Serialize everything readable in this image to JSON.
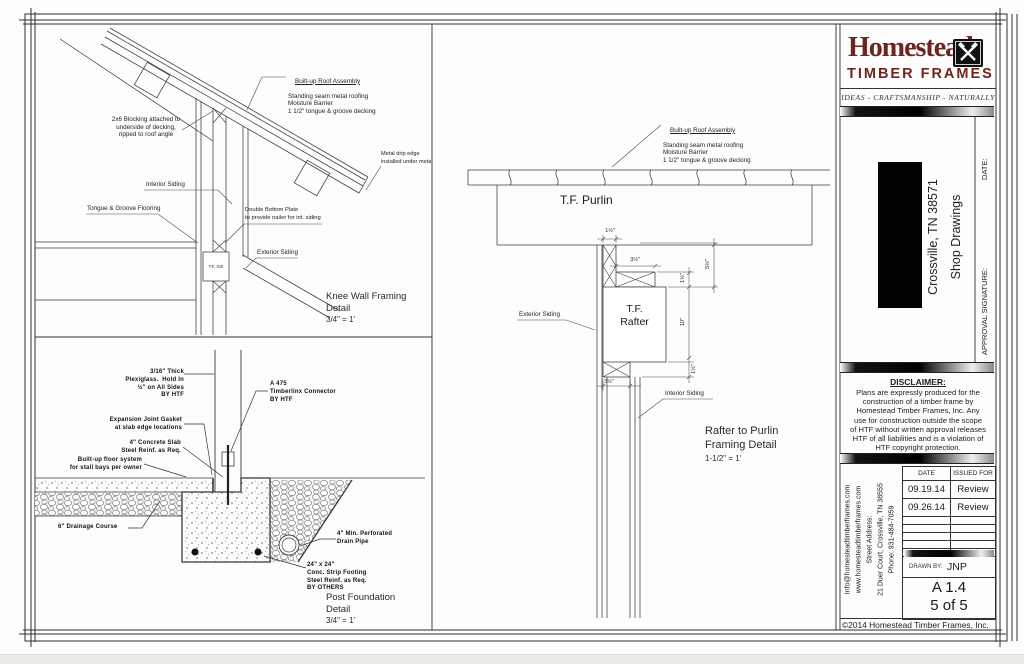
{
  "brand": {
    "name": "Homestead",
    "word2": "TIMBER FRAMES",
    "tagline": "IDEAS - CRAFTSMANSHIP - NATURALLY",
    "color": "#6e2420"
  },
  "project": {
    "location": "Crossville, TN 38571",
    "type": "Shop Drawings",
    "approval_label": "APPROVAL SIGNATURE:",
    "date_label": "DATE:"
  },
  "disclaimer": {
    "title": "DISCLAIMER:",
    "body": "Plans are expressly produced for the\nconstruction of a timber frame by\nHomestead Timber Frames, Inc. Any\nuse for construction outside the scope\nof HTF without written approval releases\nHTF of all liabilities and is a violation of\nHTF copyright protection."
  },
  "contact": {
    "email": "Info@homesteadtimberframes.com",
    "web": "www.homesteadtimberframes.com",
    "street_label": "Street Address:",
    "street": "21 Duer Court, Crossville, TN 38555",
    "phone": "Phone: 931-484-7059"
  },
  "revisions": {
    "date_header": "DATE",
    "issued_header": "ISSUED FOR",
    "rows": [
      [
        "09.19.14",
        "Review"
      ],
      [
        "09.26.14",
        "Review"
      ]
    ]
  },
  "titleblock": {
    "drawn_by_label": "DRAWN BY:",
    "drawn_by": "JNP",
    "sheet": "A 1.4",
    "page": "5 of 5",
    "copyright": "©2014 Homestead Timber Frames, Inc."
  },
  "shared": {
    "roof_assembly_title": "Built-up Roof Assembly",
    "roof_assembly_rest": "Standing seam metal roofing\nMoisture Barrier\n1 1/2\" tongue & groove decking"
  },
  "knee_wall": {
    "blocking": "2x6 Blocking attached to\nunderside of decking,\nripped to roof angle",
    "drip_edge": "Metal drip edge\ninstalled under metal ro",
    "interior_siding": "Interior Siding",
    "tongue_groove": "Tongue & Groove Flooring",
    "double_bottom_plate": "Double Bottom Plate\nto provide nailer for int. siding",
    "exterior_siding": "Exterior Siding",
    "girt": "T.F. Girt",
    "title": "Knee Wall Framing\nDetail",
    "scale": "3/4\" = 1'"
  },
  "post_foundation": {
    "plexiglass": "3/16\" Thick\nPlexiglass.  Hold In\n½\" on All Sides\nBY HTF",
    "connector": "A 475\nTimberlinx Connector\nBY HTF",
    "expansion_joint": "Expansion Joint Gasket\nat slab edge locations",
    "slab": "4\" Concrete Slab\nSteel Reinf. as Req.",
    "floor_system": "Built-up floor system\nfor stall bays per owner",
    "drainage": "6\" Drainage Course",
    "drain_pipe": "4\" Min. Perforated\nDrain Pipe",
    "footing": "24\" x 24\"\nConc. Strip Footing\nSteel Reinf. as Req.\nBY OTHERS",
    "title": "Post Foundation\nDetail",
    "scale": "3/4\" = 1'"
  },
  "rafter_purlin": {
    "purlin": "T.F. Purlin",
    "rafter": "T.F.\nRafter",
    "exterior_siding": "Exterior Siding",
    "interior_siding": "Interior Siding",
    "title": "Rafter to Purlin\nFraming Detail",
    "scale": "1-1/2\" = 1'",
    "dims": {
      "d1": "1½\"",
      "d2": "3½\"",
      "d3": "1½\"",
      "d4": "5½\"",
      "d5": "10\"",
      "d6": "1½\"",
      "d7": "3½\""
    }
  }
}
